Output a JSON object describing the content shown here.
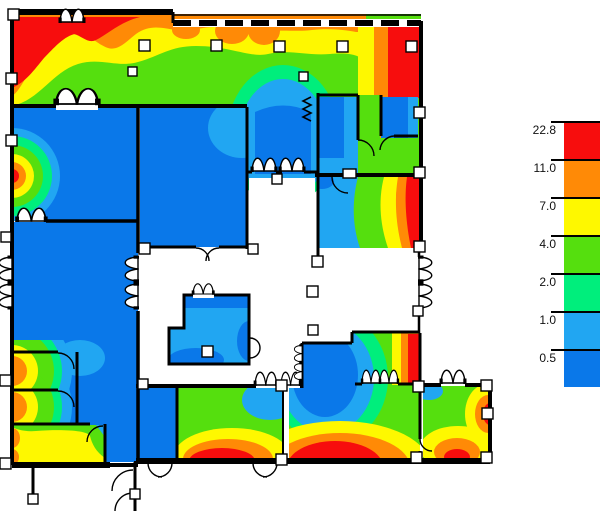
{
  "palette": {
    "red": "#F70D0D",
    "orange": "#FF8A06",
    "yellow": "#FEF800",
    "green": "#55DF0E",
    "spring": "#00EE7C",
    "lightblue": "#21A6F2",
    "blue": "#0A78E9",
    "wall": "#000000",
    "background": "#FFFFFF"
  },
  "legend": {
    "labels": [
      "22.8",
      "11.0",
      "7.0",
      "4.0",
      "2.0",
      "1.0",
      "0.5"
    ]
  },
  "chart_data": {
    "type": "heatmap",
    "title": "",
    "legend_position": "right",
    "legend_values": [
      22.8,
      11.0,
      7.0,
      4.0,
      2.0,
      1.0,
      0.5
    ],
    "color_bands": [
      {
        "value": "22.8",
        "color_key": "red"
      },
      {
        "value": "11.0",
        "color_key": "orange"
      },
      {
        "value": "7.0",
        "color_key": "yellow"
      },
      {
        "value": "4.0",
        "color_key": "green"
      },
      {
        "value": "2.0",
        "color_key": "spring"
      },
      {
        "value": "1.0",
        "color_key": "lightblue"
      },
      {
        "value": "0.5",
        "color_key": "blue"
      }
    ],
    "description": "False-color value map over a building floor plan; hot (red/orange) zones along the top, left, right and bottom window walls, cool (blue) interior rooms, unshaded central atrium"
  }
}
